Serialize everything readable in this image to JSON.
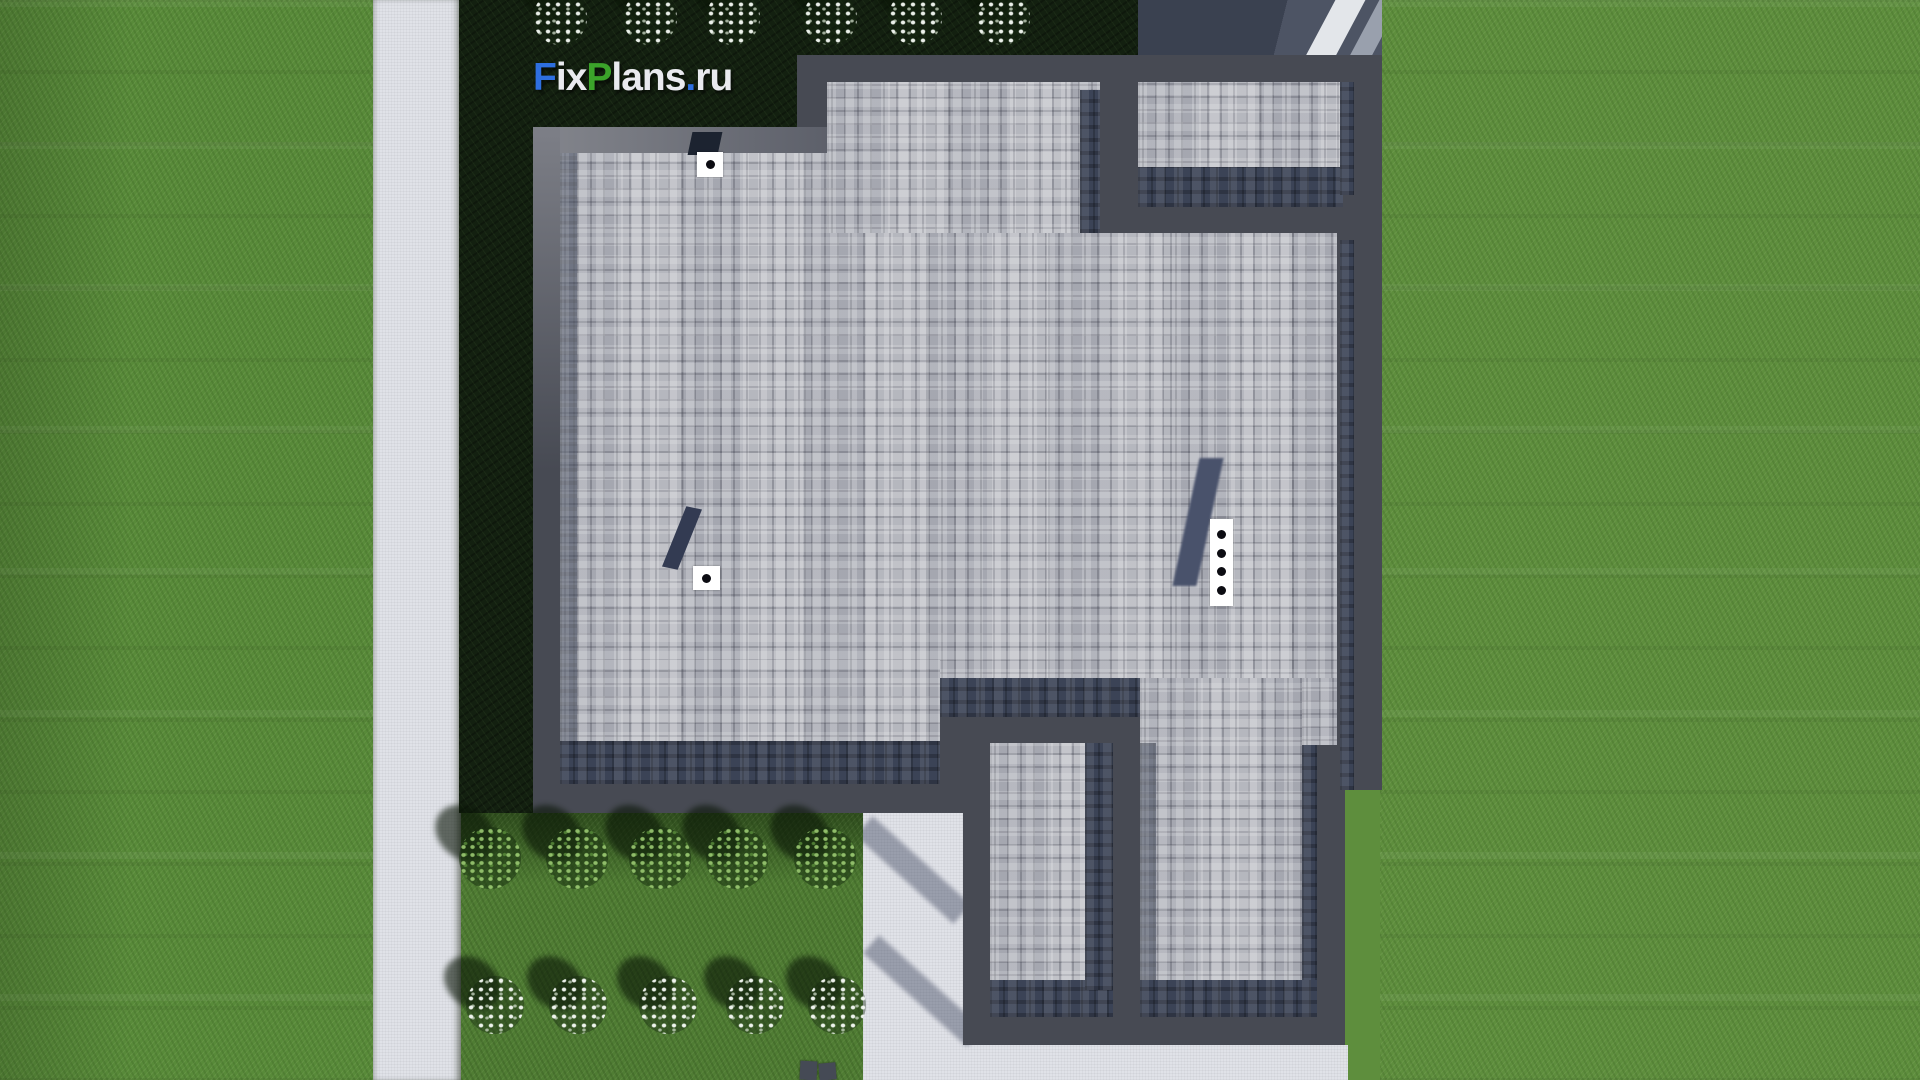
{
  "watermark": {
    "text": "FixPlans.ru",
    "parts": [
      {
        "t": "F",
        "c": "blue"
      },
      {
        "t": "ix",
        "c": "light"
      },
      {
        "t": "P",
        "c": "green"
      },
      {
        "t": "lans",
        "c": "light"
      },
      {
        "t": ".",
        "c": "blue"
      },
      {
        "t": "ru",
        "c": "light"
      }
    ]
  },
  "colors": {
    "charcoal": "#474a53",
    "shingle": "#aeb0b8",
    "shingleDark": "#3b4356",
    "grass": "#5e8e3d",
    "grassLeft": "#588a39",
    "garden": "#4f7c33",
    "hedge": "#16240f",
    "bedDark": "#132010",
    "walk": "#e0e2e8",
    "driveway": "#4d5464",
    "drivewayShadow": "#3a4150",
    "navy": "#39415a",
    "white": "#ffffff",
    "logoBlue": "#2e6fe0",
    "logoGreen": "#3ba32a",
    "logoLight": "#e9eaef",
    "chimneyShadow": "#49526b",
    "binGray": "#454a55"
  },
  "scene": {
    "type": "aerial-3d-render",
    "subject": "flat shingled roof of a house with parapet walls, viewed from directly above",
    "top_flower_count": 6,
    "garden_bush_count": 5,
    "garden_flower_count": 5,
    "roof_vent_count": 2,
    "chimney_flue_count": 4,
    "road_marking": "white diagonal stripe on driveway, top right"
  },
  "vegetation": {
    "rows": [
      {
        "name": "top-flowers",
        "cls": "white flat",
        "item": "flower-cluster",
        "cy": 18,
        "r": 27,
        "x": [
          560,
          650,
          733,
          830,
          915,
          1003
        ]
      },
      {
        "name": "garden-bushes",
        "cls": "bush",
        "item": "bush",
        "cy": 858,
        "r": 31,
        "x": [
          490,
          577,
          660,
          737,
          825
        ]
      },
      {
        "name": "garden-flowers",
        "cls": "white",
        "item": "flower-cluster",
        "cy": 1005,
        "r": 29,
        "x": [
          495,
          578,
          668,
          755,
          837
        ]
      }
    ]
  },
  "roof": {
    "chimney": {
      "dots": 4
    },
    "vent": {
      "dots": 1
    }
  }
}
